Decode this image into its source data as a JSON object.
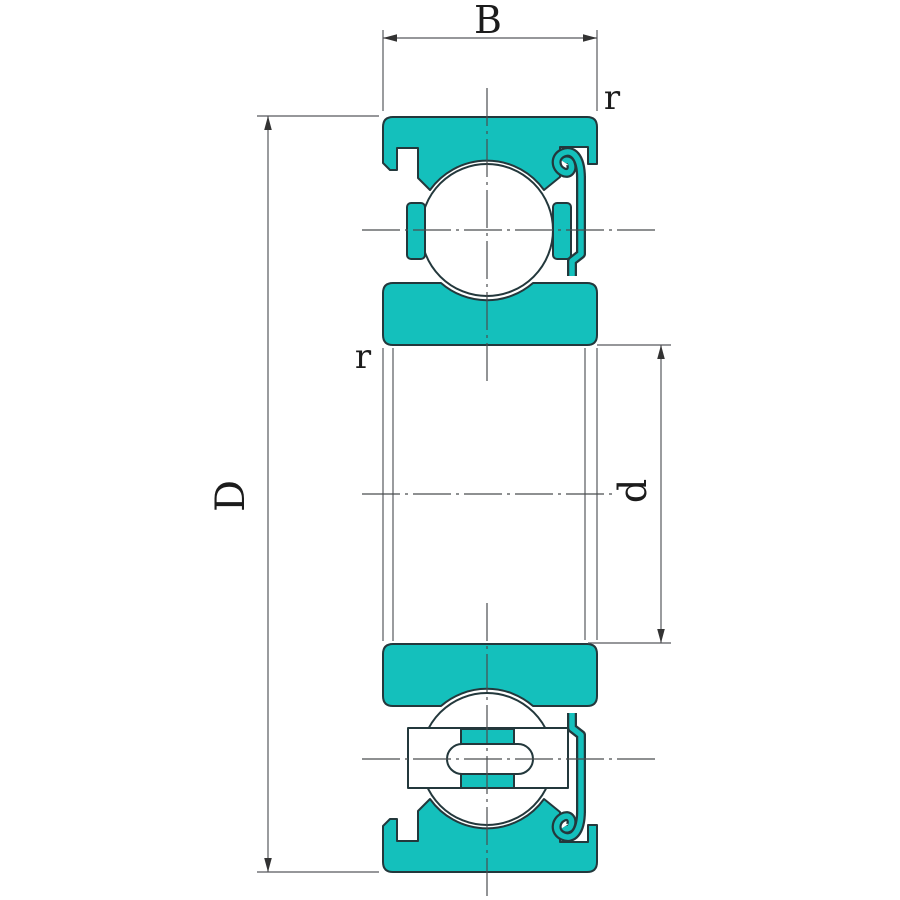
{
  "drawing": {
    "labels": {
      "width": "B",
      "outer_diameter": "D",
      "bore_diameter": "d",
      "fillet_top_right": "r",
      "fillet_inner_left": "r"
    },
    "colors": {
      "ring_teal": "#14c0bc",
      "outline_dark": "#23383c",
      "dimension_line_gray": "#58595e",
      "centerline_gray": "#4a4d4f",
      "background": "#ffffff"
    }
  }
}
